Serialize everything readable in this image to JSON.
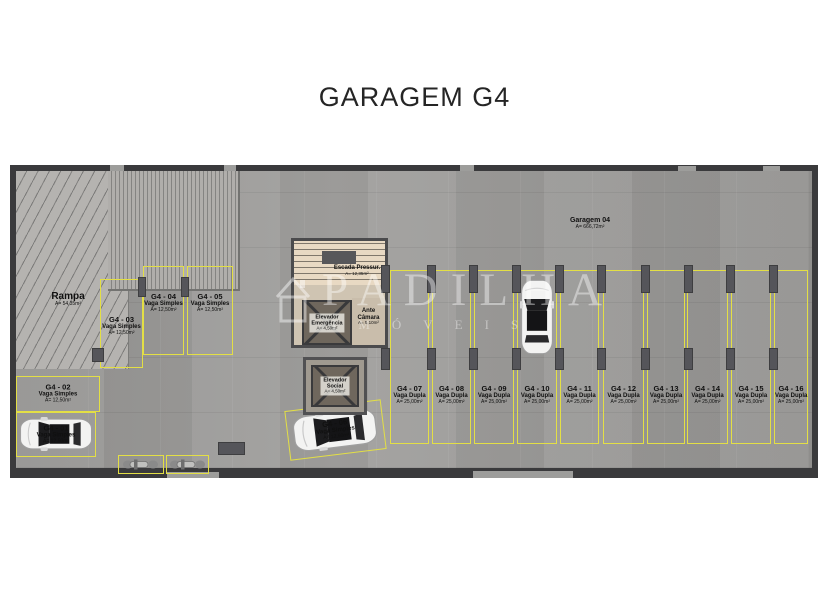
{
  "title": "GARAGEM G4",
  "watermark": {
    "brand": "PADILHA",
    "tagline": "IMÓVEIS"
  },
  "plan": {
    "garage": {
      "name": "Garagem 04",
      "area": "A= 666,72m²"
    },
    "ramp": {
      "name": "Rampa",
      "area": "A= 54,35m²"
    },
    "core": {
      "stairs": {
        "name": "Escada Pressur.",
        "area": "A= 12,35m²"
      },
      "emergency_elevator": {
        "name": "Elevador Emergência",
        "area": "A= 4,50m²"
      },
      "ante_chamber": {
        "name": "Ante Câmara",
        "area": "A= 5,10m²"
      },
      "social_elevator": {
        "name": "Elevador Social",
        "area": "A= 4,50m²"
      }
    },
    "spots": [
      {
        "id": "G4 - 01",
        "type": "Vaga Simples",
        "area": "A= 12,50m²"
      },
      {
        "id": "G4 - 02",
        "type": "Vaga Simples",
        "area": "A= 12,50m²"
      },
      {
        "id": "G4 - 03",
        "type": "Vaga Simples",
        "area": "A= 12,50m²"
      },
      {
        "id": "G4 - 04",
        "type": "Vaga Simples",
        "area": "A= 12,50m²"
      },
      {
        "id": "G4 - 05",
        "type": "Vaga Simples",
        "area": "A= 12,50m²"
      },
      {
        "id": "G4 - 06",
        "type": "Vaga Simples",
        "area": "A= 12,50m²"
      },
      {
        "id": "G4 - 07",
        "type": "Vaga Dupla",
        "area": "A= 25,00m²"
      },
      {
        "id": "G4 - 08",
        "type": "Vaga Dupla",
        "area": "A= 25,00m²"
      },
      {
        "id": "G4 - 09",
        "type": "Vaga Dupla",
        "area": "A= 25,00m²"
      },
      {
        "id": "G4 - 10",
        "type": "Vaga Dupla",
        "area": "A= 25,00m²"
      },
      {
        "id": "G4 - 11",
        "type": "Vaga Dupla",
        "area": "A= 25,00m²"
      },
      {
        "id": "G4 - 12",
        "type": "Vaga Dupla",
        "area": "A= 25,00m²"
      },
      {
        "id": "G4 - 13",
        "type": "Vaga Dupla",
        "area": "A= 25,00m²"
      },
      {
        "id": "G4 - 14",
        "type": "Vaga Dupla",
        "area": "A= 25,00m²"
      },
      {
        "id": "G4 - 15",
        "type": "Vaga Dupla",
        "area": "A= 25,00m²"
      },
      {
        "id": "G4 - 16",
        "type": "Vaga Dupla",
        "area": "A= 25,00m²"
      }
    ]
  }
}
